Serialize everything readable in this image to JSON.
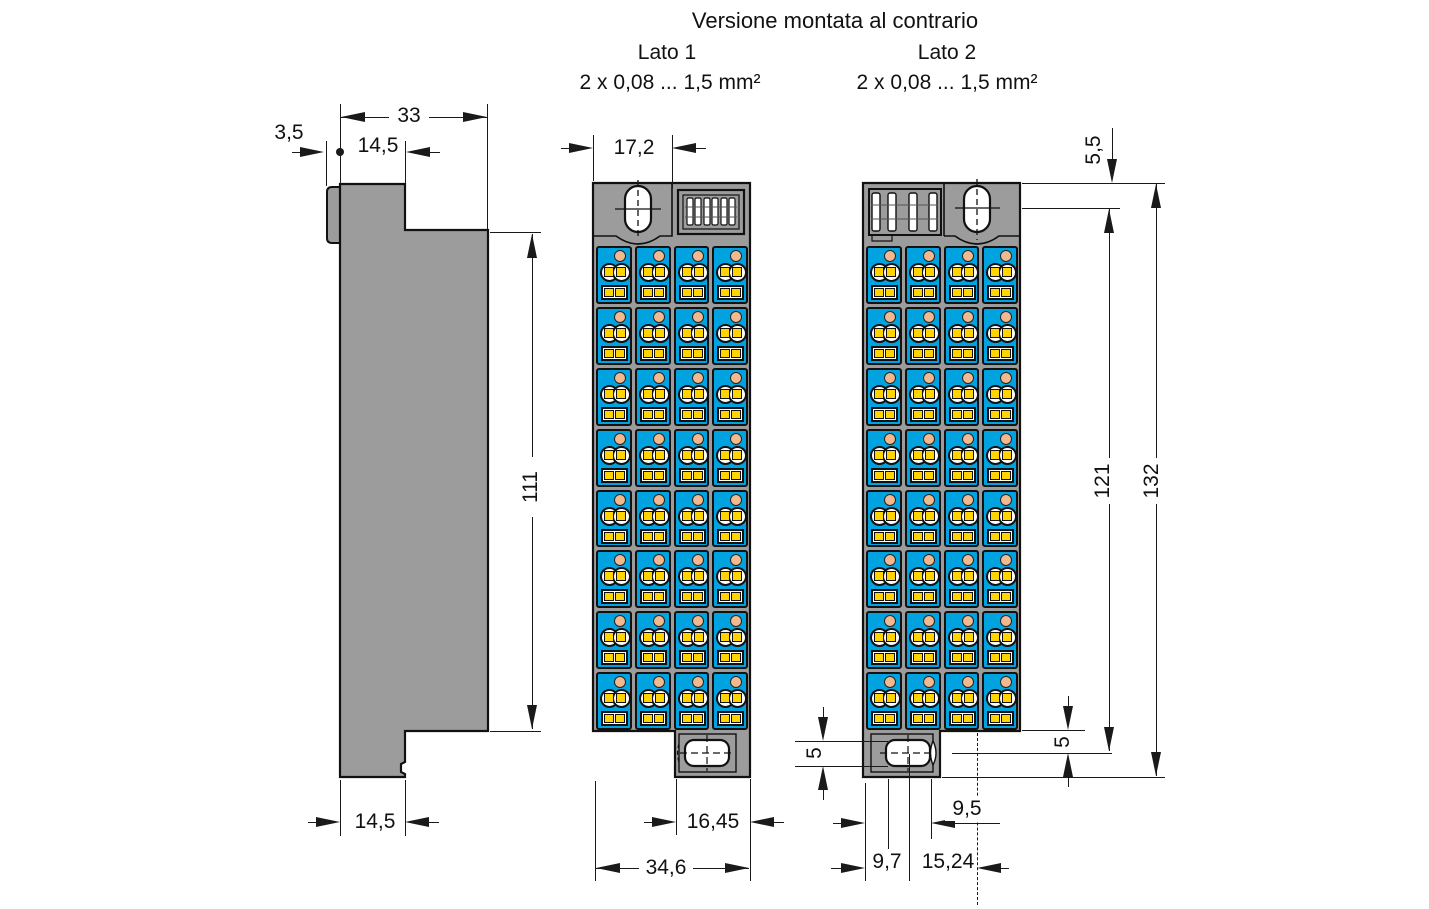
{
  "title": "Versione montata al contrario",
  "sides": {
    "lato1": {
      "label": "Lato 1",
      "wire_range": "2 x 0,08 ... 1,5 mm²"
    },
    "lato2": {
      "label": "Lato 2",
      "wire_range": "2 x 0,08 ... 1,5 mm²"
    }
  },
  "dimensions_mm": {
    "side_tab_depth": "3,5",
    "side_top_width": "14,5",
    "side_total_depth": "33",
    "side_body_height": "111",
    "side_foot_width": "14,5",
    "front_top_width": "17,2",
    "front_foot_width": "16,45",
    "front_total_width": "34,6",
    "top_slot_offset": "5,5",
    "slot_center_distance": "121",
    "total_height": "132",
    "foot_slot_offset": "5",
    "foot_slot_height": "5",
    "foot_slot_to_pin": "9,5",
    "foot_left_to_slot_center": "9,7",
    "pin_spacing": "15,24"
  },
  "grid": {
    "rows": 8,
    "cols": 4
  },
  "colors": {
    "body_gray": "#9c9c9c",
    "module_blue": "#00a3e0",
    "marker_yellow": "#ffd400",
    "port_peach": "#f3b98e",
    "line_black": "#1a1a1a"
  }
}
